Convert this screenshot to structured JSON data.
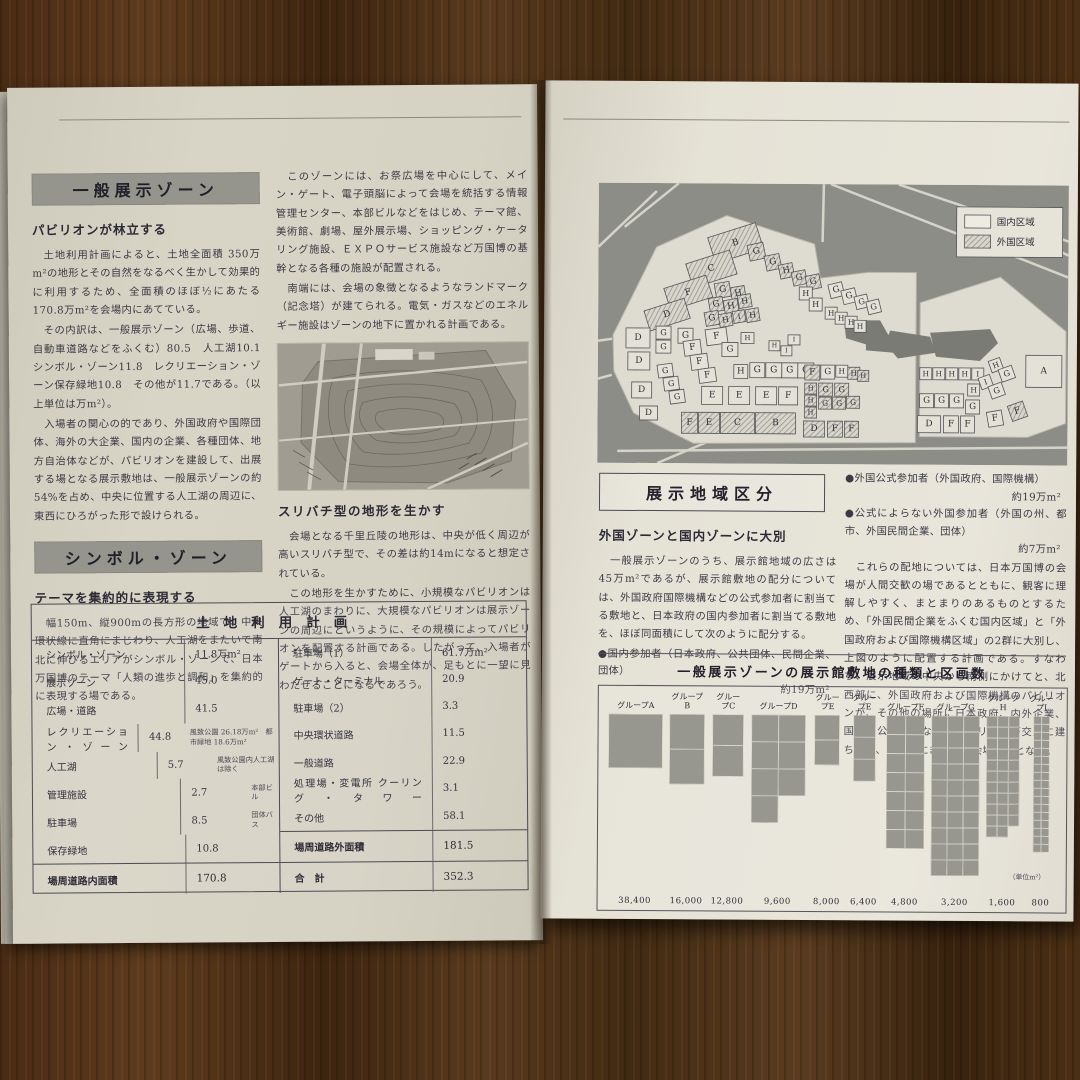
{
  "left_page": {
    "sections": [
      {
        "bar": "一般展示ゾーン",
        "subhead": "パビリオンが林立する",
        "paragraphs": [
          "　土地利用計画によると、土地全面積 350万m²の地形とその自然をなるべく生かして効果的に利用するため、全面積のほぼ½にあたる 170.8万m²を会場内にあてている。",
          "　その内訳は、一般展示ゾーン（広場、歩道、自動車道路などをふくむ）80.5　人工湖10.1　シンボル・ゾーン11.8　レクリエーション・ゾーン保存緑地10.8　その他が11.7である。（以上単位は万m²）。",
          "　入場者の関心の的であり、外国政府や国際団体、海外の大企業、国内の企業、各種団体、地方自治体などが、パビリオンを建設して、出展する場となる展示敷地は、一般展示ゾーンの約54%を占め、中央に位置する人工湖の周辺に、東西にひろがった形で設けられる。"
        ]
      },
      {
        "bar": "シンボル・ゾーン",
        "subhead": "テーマを集約的に表現する",
        "paragraphs": [
          "　幅150m、縦900mの長方形の地域で、中央環状線に直角にまじわり、人工湖をまたいで南北に伸びるエリアがシンボル・ゾーンで、日本万国博のテーマ「人類の進歩と調和」を集約的に表現する場である。"
        ]
      }
    ],
    "middle_column": {
      "top_paragraphs": [
        "　このゾーンには、お祭広場を中心にして、メイン・ゲート、電子頭脳によって会場を統括する情報管理センター、本部ビルなどをはじめ、テーマ館、美術館、劇場、屋外展示場、ショッピング・ケータリング施設、ＥＸＰＯサービス施設など万国博の基幹となる各種の施設が配置される。",
        "　南端には、会場の象徴となるようなランドマーク（記念塔）が建てられる。電気・ガスなどのエネルギー施設はゾーンの地下に置かれる計画である。"
      ],
      "photo_caption": "スリバチ型の地形を生かす",
      "bottom_paragraphs": [
        "　会場となる千里丘陵の地形は、中央が低く周辺が高いスリバチ型で、その差は約14mになると想定されている。",
        "　この地形を生かすために、小規模なパビリオンは人工湖のまわりに、大規模なパビリオンは展示ゾーンの周辺にというように、その規模によってパビリオンを配置する計画である。したがって、入場者がゲートから入ると、会場全体が、足もとに一望に見わたせることになるであろう。"
      ]
    },
    "table": {
      "title": "土地利用計画",
      "left_rows": [
        {
          "label": "シンボル・ゾーン",
          "value": "11.8万m²",
          "note": ""
        },
        {
          "label": "展示ゾーン",
          "value": "45.0",
          "note": ""
        },
        {
          "label": "広場・道路",
          "value": "41.5",
          "note": ""
        },
        {
          "label": "レクリエーション・ゾーン",
          "value": "44.8",
          "note": "風致公園 26.18万m²　都市緑地 18.6万m²"
        },
        {
          "label": "人工湖",
          "value": "5.7",
          "note": "風致公園内人工湖は除く"
        },
        {
          "label": "管理施設",
          "value": "2.7",
          "note": "本部ビル"
        },
        {
          "label": "駐車場",
          "value": "8.5",
          "note": "団体バス"
        },
        {
          "label": "保存緑地",
          "value": "10.8",
          "note": ""
        }
      ],
      "left_total": {
        "label": "場周道路内面積",
        "value": "170.8"
      },
      "right_rows": [
        {
          "label": "駐車場（1）",
          "value": "61.7万m²",
          "note": ""
        },
        {
          "label": "ゲート・ターミナル",
          "value": "20.9",
          "note": ""
        },
        {
          "label": "駐車場（2）",
          "value": "3.3",
          "note": ""
        },
        {
          "label": "中央環状道路",
          "value": "11.5",
          "note": ""
        },
        {
          "label": "一般道路",
          "value": "22.9",
          "note": ""
        },
        {
          "label": "処理場・変電所 クーリング・タワー",
          "value": "3.1",
          "note": ""
        },
        {
          "label": "その他",
          "value": "58.1",
          "note": ""
        }
      ],
      "right_total": {
        "label": "場周道路外面積",
        "value": "181.5"
      },
      "grand_total": {
        "label": "合　計",
        "value": "352.3"
      }
    }
  },
  "right_page": {
    "heading_box": "展示地域区分",
    "subhead": "外国ゾーンと国内ゾーンに大別",
    "paragraphs": [
      "　一般展示ゾーンのうち、展示館地域の広さは45万m²であるが、展示館敷地の配分については、外国政府国際機構などの公式参加者に割当てる敷地と、日本政府の国内参加者に割当てる敷地を、ほぼ同面積にして次のように配分する。"
    ],
    "bullet_domestic": {
      "text": "●国内参加者（日本政府、公共団体、民間企業、団体）",
      "amount": "約19万m²"
    },
    "bullets_foreign": [
      {
        "text": "●外国公式参加者（外国政府、国際機構）",
        "amount": "約19万m²"
      },
      {
        "text": "●公式によらない外国参加者（外国の州、都市、外国民間企業、団体）",
        "amount": "約7万m²"
      }
    ],
    "right_column_paragraph": "　これらの配地については、日本万国博の会場が人間交歓の場であるとともに、観客に理解しやすく、まとまりのあるものとするため、「外国民間企業をふくむ国内区域」と「外国政府および国際機構区域」の2群に大別し、上図のように配置する計画である。すなわち、展示地域の中央から南側にかけてと、北西部に、外国政府および国際機構のパビリオンが、その他の場所に日本政府、内外企業、国内の公共団体などのパビリオンが交互に建ち並び、楽しくにぎやかな会場構成となる。",
    "map": {
      "legend": [
        {
          "label": "国内区域",
          "fill": "plain"
        },
        {
          "label": "外国区域",
          "fill": "hatched"
        }
      ],
      "site_polygons": [
        "15,152 58,64 128,32 216,60 222,94 270,88 318,88 318,258 96,260 36,230 16,188",
        "322,118 402,92 468,146 468,238 430,252 322,252"
      ],
      "lakes": [
        "246,136 282,136 290,150 268,160 248,154",
        "292,146 332,152 338,168 300,174 288,160",
        "332,148 392,144 400,158 382,176 338,172",
        "268,150 318,150 318,170 268,166"
      ],
      "roads": [
        [
          0,
          64,
          58,
          8
        ],
        [
          26,
          44,
          80,
          0
        ],
        [
          225,
          0,
          224,
          58
        ],
        [
          232,
          0,
          470,
          92
        ],
        [
          300,
          0,
          470,
          56
        ],
        [
          0,
          158,
          14,
          156
        ],
        [
          0,
          196,
          14,
          192
        ],
        [
          20,
          268,
          470,
          262
        ],
        [
          60,
          280,
          130,
          250
        ],
        [
          440,
          56,
          470,
          70
        ]
      ],
      "parcels": [
        [
          "B",
          112,
          46,
          50,
          27,
          "h",
          -18
        ],
        [
          "C",
          90,
          73,
          46,
          25,
          "h",
          -18
        ],
        [
          "F",
          68,
          98,
          44,
          23,
          "h",
          -18
        ],
        [
          "D",
          48,
          121,
          42,
          21,
          "h",
          -18
        ],
        [
          "G",
          150,
          60,
          16,
          16,
          "h",
          -12
        ],
        [
          "G",
          167,
          71,
          15,
          15,
          "h",
          -12
        ],
        [
          "H",
          181,
          80,
          14,
          14,
          "h",
          -12
        ],
        [
          "G",
          194,
          87,
          14,
          14,
          "h",
          -12
        ],
        [
          "G",
          208,
          91,
          14,
          14,
          "h",
          -12
        ],
        [
          "G",
          117,
          99,
          15,
          15,
          "h",
          -10
        ],
        [
          "H",
          133,
          103,
          14,
          14,
          "h",
          -10
        ],
        [
          "G",
          111,
          114,
          14,
          14,
          "h",
          -10
        ],
        [
          "H",
          126,
          116,
          14,
          14,
          "h",
          -10
        ],
        [
          "H",
          140,
          111,
          13,
          13,
          "h",
          -10
        ],
        [
          "G",
          107,
          128,
          14,
          14,
          "h",
          -10
        ],
        [
          "H",
          121,
          130,
          13,
          13,
          "h",
          -10
        ],
        [
          "I",
          135,
          127,
          12,
          12,
          "h",
          -10
        ],
        [
          "H",
          148,
          125,
          13,
          13,
          "h",
          -10
        ],
        [
          "H",
          201,
          103,
          13,
          13,
          "w",
          0
        ],
        [
          "H",
          211,
          114,
          13,
          13,
          "w",
          0
        ],
        [
          "G",
          231,
          99,
          14,
          14,
          "w",
          -14
        ],
        [
          "G",
          244,
          105,
          14,
          14,
          "w",
          -14
        ],
        [
          "G",
          257,
          111,
          13,
          13,
          "w",
          -14
        ],
        [
          "G",
          269,
          116,
          13,
          13,
          "w",
          -14
        ],
        [
          "H",
          227,
          123,
          12,
          12,
          "w",
          0
        ],
        [
          "H",
          237,
          128,
          12,
          12,
          "w",
          0
        ],
        [
          "H",
          247,
          132,
          12,
          12,
          "w",
          0
        ],
        [
          "H",
          256,
          136,
          12,
          12,
          "w",
          0
        ],
        [
          "H",
          143,
          149,
          13,
          11,
          "w",
          0
        ],
        [
          "I",
          190,
          151,
          12,
          10,
          "w",
          0
        ],
        [
          "H",
          171,
          157,
          11,
          10,
          "w",
          0
        ],
        [
          "I",
          183,
          162,
          11,
          10,
          "w",
          0
        ],
        [
          "D",
          28,
          145,
          24,
          20,
          "w",
          0
        ],
        [
          "G",
          58,
          143,
          15,
          13,
          "w",
          0
        ],
        [
          "G",
          58,
          157,
          15,
          13,
          "w",
          0
        ],
        [
          "G",
          80,
          145,
          15,
          15,
          "w",
          0
        ],
        [
          "F",
          108,
          145,
          21,
          16,
          "w",
          -8
        ],
        [
          "G",
          124,
          159,
          16,
          14,
          "w",
          0
        ],
        [
          "F",
          86,
          157,
          17,
          15,
          "w",
          -8
        ],
        [
          "F",
          93,
          171,
          17,
          15,
          "w",
          -8
        ],
        [
          "F",
          101,
          185,
          17,
          14,
          "w",
          -8
        ],
        [
          "G",
          60,
          181,
          15,
          13,
          "w",
          -8
        ],
        [
          "G",
          66,
          194,
          15,
          13,
          "w",
          -8
        ],
        [
          "G",
          72,
          207,
          15,
          13,
          "w",
          -8
        ],
        [
          "D",
          30,
          169,
          22,
          18,
          "w",
          0
        ],
        [
          "D",
          34,
          199,
          20,
          16,
          "w",
          0
        ],
        [
          "D",
          42,
          223,
          18,
          14,
          "w",
          0
        ],
        [
          "H",
          136,
          181,
          14,
          14,
          "w",
          0
        ],
        [
          "G",
          152,
          179,
          15,
          15,
          "w",
          0
        ],
        [
          "G",
          168,
          179,
          16,
          15,
          "w",
          0
        ],
        [
          "G",
          184,
          179,
          16,
          15,
          "w",
          0
        ],
        [
          "G",
          200,
          179,
          16,
          15,
          "w",
          0
        ],
        [
          "E",
          104,
          203,
          21,
          18,
          "w",
          0
        ],
        [
          "E",
          131,
          203,
          21,
          18,
          "w",
          0
        ],
        [
          "E",
          158,
          203,
          21,
          18,
          "w",
          0
        ],
        [
          "F",
          181,
          203,
          19,
          18,
          "w",
          0
        ],
        [
          "F",
          84,
          229,
          16,
          21,
          "h",
          0
        ],
        [
          "E",
          101,
          229,
          21,
          21,
          "h",
          0
        ],
        [
          "C",
          123,
          229,
          34,
          21,
          "h",
          0
        ],
        [
          "B",
          158,
          229,
          40,
          21,
          "h",
          0
        ],
        [
          "F",
          207,
          181,
          15,
          15,
          "h",
          0
        ],
        [
          "G",
          223,
          181,
          14,
          14,
          "w",
          0
        ],
        [
          "H",
          238,
          181,
          12,
          12,
          "w",
          0
        ],
        [
          "H",
          250,
          183,
          12,
          12,
          "h",
          0
        ],
        [
          "H",
          260,
          186,
          11,
          11,
          "h",
          0
        ],
        [
          "H",
          207,
          199,
          12,
          11,
          "h",
          0
        ],
        [
          "H",
          207,
          211,
          12,
          11,
          "h",
          0
        ],
        [
          "H",
          207,
          223,
          12,
          11,
          "h",
          0
        ],
        [
          "G",
          221,
          199,
          14,
          13,
          "h",
          0
        ],
        [
          "G",
          237,
          199,
          14,
          13,
          "h",
          0
        ],
        [
          "G",
          221,
          213,
          13,
          12,
          "h",
          0
        ],
        [
          "G",
          235,
          213,
          13,
          12,
          "h",
          0
        ],
        [
          "G",
          249,
          212,
          13,
          12,
          "h",
          0
        ],
        [
          "D",
          206,
          237,
          21,
          16,
          "h",
          0
        ],
        [
          "F",
          230,
          237,
          15,
          16,
          "h",
          0
        ],
        [
          "F",
          247,
          237,
          14,
          16,
          "h",
          0
        ],
        [
          "H",
          322,
          183,
          12,
          12,
          "w",
          0
        ],
        [
          "H",
          335,
          183,
          12,
          12,
          "w",
          0
        ],
        [
          "H",
          348,
          183,
          12,
          12,
          "w",
          0
        ],
        [
          "H",
          361,
          183,
          12,
          12,
          "w",
          0
        ],
        [
          "I",
          374,
          183,
          12,
          12,
          "w",
          0
        ],
        [
          "H",
          392,
          174,
          12,
          12,
          "w",
          -20
        ],
        [
          "G",
          402,
          182,
          14,
          13,
          "w",
          -20
        ],
        [
          "I",
          382,
          191,
          12,
          12,
          "w",
          -20
        ],
        [
          "G",
          392,
          199,
          14,
          13,
          "w",
          -20
        ],
        [
          "H",
          370,
          199,
          12,
          12,
          "w",
          0
        ],
        [
          "A",
          428,
          170,
          36,
          32,
          "w",
          0
        ],
        [
          "G",
          322,
          209,
          14,
          14,
          "w",
          0
        ],
        [
          "G",
          337,
          209,
          14,
          14,
          "w",
          0
        ],
        [
          "G",
          352,
          209,
          14,
          14,
          "w",
          0
        ],
        [
          "G",
          368,
          215,
          14,
          14,
          "w",
          0
        ],
        [
          "D",
          320,
          231,
          23,
          17,
          "w",
          0
        ],
        [
          "F",
          346,
          231,
          15,
          17,
          "w",
          0
        ],
        [
          "F",
          363,
          231,
          14,
          17,
          "w",
          0
        ],
        [
          "F",
          390,
          226,
          15,
          15,
          "w",
          -10
        ],
        [
          "F",
          412,
          218,
          16,
          16,
          "h",
          -20
        ]
      ]
    },
    "chart_title": "一般展示ゾーンの展示館敷地の種類と区画数",
    "unit_note": "（単位m²）"
  },
  "chart_data": {
    "type": "bar",
    "title": "一般展示ゾーンの展示館敷地の種類と区画数",
    "categories": [
      "グループA",
      "グループB",
      "グループC",
      "グループD",
      "グループE",
      "グループE",
      "グループF",
      "グループG",
      "グループH",
      "グループI"
    ],
    "parcel_area_m2": [
      38400,
      16000,
      12800,
      9600,
      8000,
      6400,
      4800,
      3200,
      1600,
      800
    ],
    "value_labels": [
      "38,400",
      "16,000",
      "12,800",
      "9,600",
      "8,000",
      "6,400",
      "4,800",
      "3,200",
      "1,600",
      "800"
    ],
    "parcel_counts_est": [
      1,
      2,
      2,
      7,
      2,
      3,
      14,
      30,
      32,
      34
    ],
    "unit": "（単位m²）",
    "layout": {
      "columns": [
        1,
        1,
        1,
        2,
        1,
        1,
        2,
        3,
        3,
        2
      ],
      "legend_position": "none",
      "grid": false
    }
  }
}
